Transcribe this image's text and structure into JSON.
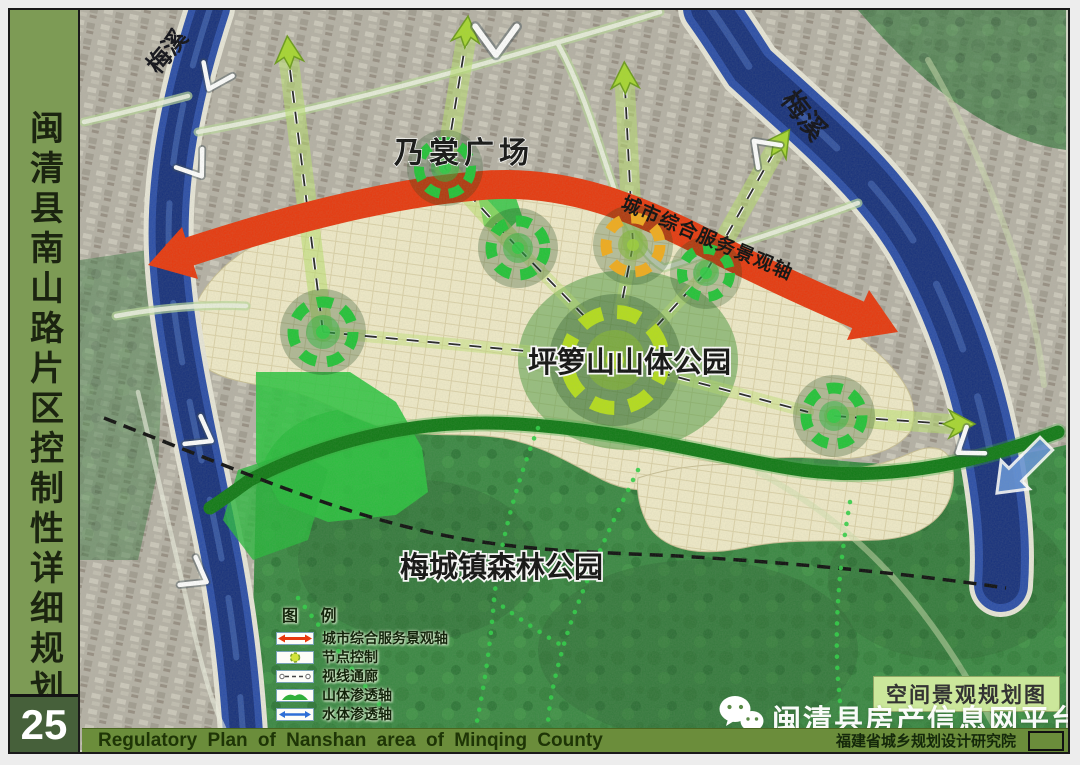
{
  "sidebar": {
    "title": "闽清县南山路片区控制性详细规划",
    "page_number": "25"
  },
  "bottom_bar": {
    "english_title": "Regulatory  Plan of  Nanshan area of  Minqing County",
    "institute": "福建省城乡规划设计研究院"
  },
  "watermark": {
    "platform": "闽清县房产信息网平台"
  },
  "map": {
    "plan_type_label": "空间景观规划图",
    "axis_label": "城市综合服务景观轴",
    "labels": {
      "naishang_square": "乃裳广场",
      "pingluoshan_park": "坪箩山山体公园",
      "meicheng_forest_park": "梅城镇森林公园",
      "river_left": "梅溪",
      "river_right": "梅溪"
    },
    "legend": {
      "title": "图 例",
      "items": [
        {
          "name": "city-service-axis",
          "label": "城市综合服务景观轴"
        },
        {
          "name": "node-control",
          "label": "节点控制"
        },
        {
          "name": "sight-corridor",
          "label": "视线通廊"
        },
        {
          "name": "mountain-permeation-axis",
          "label": "山体渗透轴"
        },
        {
          "name": "water-permeation-axis",
          "label": "水体渗透轴"
        }
      ]
    }
  },
  "colors": {
    "axis_red": "#e8380d",
    "node_green": "#22c437",
    "node_yellow": "#f2ac1c",
    "node_big_ring": "#b5de1b",
    "sidebar_green": "#7d9b55",
    "bar_green": "#6b8d3b",
    "river_blue": "#16307c",
    "corridor_green": "#b8e06a"
  }
}
